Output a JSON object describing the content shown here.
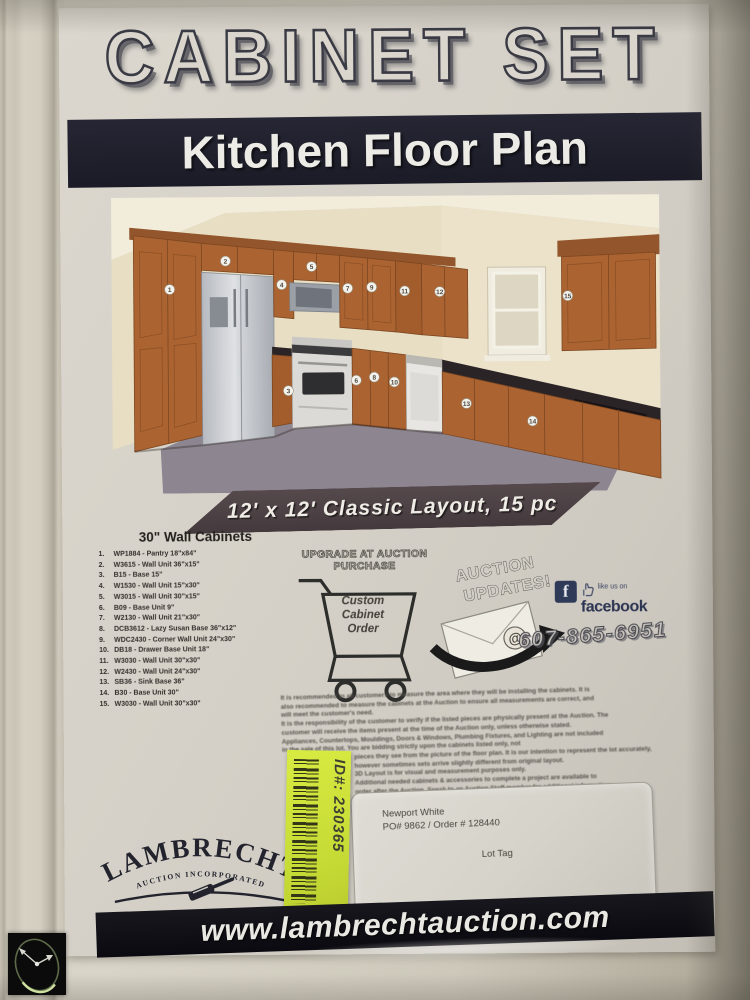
{
  "poster": {
    "title": "CABINET SET",
    "subtitle": "Kitchen Floor Plan",
    "layout_banner": "12' x 12' Classic Layout, 15 pc",
    "cabinet_list": {
      "header": "30\" Wall Cabinets",
      "items": [
        {
          "n": "1.",
          "text": "WP1884 - Pantry 18\"x84\""
        },
        {
          "n": "2.",
          "text": "W3615 - Wall Unit 36\"x15\""
        },
        {
          "n": "3.",
          "text": "B15 - Base 15\""
        },
        {
          "n": "4.",
          "text": "W1530 - Wall Unit 15\"x30\""
        },
        {
          "n": "5.",
          "text": "W3015 - Wall Unit 30\"x15\""
        },
        {
          "n": "6.",
          "text": "B09 - Base Unit 9\""
        },
        {
          "n": "7.",
          "text": "W2130 - Wall Unit 21\"x30\""
        },
        {
          "n": "8.",
          "text": "DCB3612 - Lazy Susan Base 36\"x12\""
        },
        {
          "n": "9.",
          "text": "WDC2430 - Corner Wall Unit 24\"x30\""
        },
        {
          "n": "10.",
          "text": "DB18 - Drawer Base Unit 18\""
        },
        {
          "n": "11.",
          "text": "W3030 - Wall Unit 30\"x30\""
        },
        {
          "n": "12.",
          "text": "W2430 - Wall Unit 24\"x30\""
        },
        {
          "n": "13.",
          "text": "SB36 - Sink Base 36\""
        },
        {
          "n": "14.",
          "text": "B30 - Base Unit 30\""
        },
        {
          "n": "15.",
          "text": "W3030 - Wall Unit 30\"x30\""
        }
      ]
    },
    "upgrade_graphic": {
      "heading_line1": "UPGRADE AT AUCTION",
      "heading_line2": "PURCHASE",
      "cart_lines": [
        "Custom",
        "Cabinet",
        "Order"
      ]
    },
    "updates_graphic": {
      "line1": "AUCTION",
      "line2": "UPDATES!",
      "at_symbol": "@"
    },
    "facebook": {
      "f": "f",
      "tagline": "like us on",
      "brand": "facebook"
    },
    "phone": "607-865-6951",
    "fine_print": [
      "It is recommended to all customers to measure the area where they will be installing the cabinets.  It is",
      "also recommended to measure the cabinets at the Auction to ensure all measurements are correct, and",
      "will meet the customer's need.",
      "It is the responsibility of the customer to verify if the listed pieces are physically present at the Auction.  The",
      "customer will receive the items present at the time of the Auction only, unless otherwise stated.",
      "Appliances, Countertops, Mouldings, Doors & Windows, Plumbing Fixtures, and Lighting are not included",
      "in the sale of this lot.  You are bidding strictly upon the cabinets listed only, not",
      "pieces they see from the picture of the floor plan.  It is our intention to represent the lot accurately,",
      "however sometimes sets arrive slightly different from original layout.",
      "3D Layout is for visual and measurement purposes only.",
      "Additional needed cabinets & accessories to complete a project are available to",
      "order after the Auction.  Speak to an Auction Staff member for additional information."
    ],
    "id_sticker": {
      "text": "ID#: 230365"
    },
    "lot_label": {
      "finish": "Newport White",
      "order_line": "PO# 9862 / Order # 128440",
      "tag": "Lot Tag"
    },
    "logo": {
      "name": "LAMBRECHT",
      "subtitle": "AUCTION  INCORPORATED"
    },
    "website": "www.lambrechtauction.com",
    "kitchen": {
      "badges": [
        "1",
        "2",
        "3",
        "4",
        "5",
        "6",
        "7",
        "8",
        "9",
        "10",
        "11",
        "12",
        "13",
        "14",
        "15"
      ]
    },
    "colors": {
      "banner_dark": "#1f1f2b",
      "ribbon": "#4c4245",
      "sticker_green": "#cde23c",
      "cabinet_wood": "#ab6332",
      "paper": "#d5d1c8"
    }
  }
}
